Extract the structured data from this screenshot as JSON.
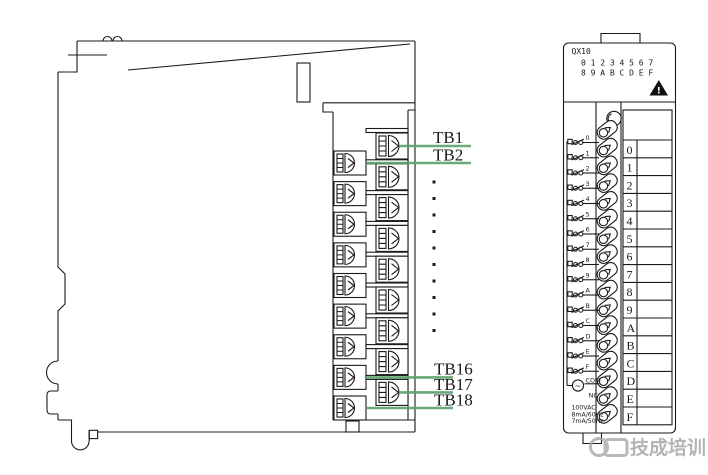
{
  "left_module": {
    "terminal_labels": [
      "TB1",
      "TB2",
      "TB16",
      "TB17",
      "TB18"
    ],
    "continuation_dots": 10,
    "inner_terminal_count": 9,
    "outer_terminal_count": 9
  },
  "right_module": {
    "model": "QX10",
    "indicator_row1": "0 1 2 3 4 5 6 7",
    "indicator_row2": "8 9 A B C D E F",
    "warning_icon": "warning-triangle",
    "switch_labels": [
      "0",
      "1",
      "2",
      "3",
      "4",
      "5",
      "6",
      "7",
      "8",
      "9",
      "A",
      "B",
      "C",
      "D",
      "E",
      "F"
    ],
    "com_label": "COM",
    "ac_symbol": "~",
    "nc_label": "NC",
    "ratings": [
      "100VAC",
      "8mA/60Hz",
      "7mA/50Hz"
    ],
    "table_labels": [
      "0",
      "1",
      "2",
      "3",
      "4",
      "5",
      "6",
      "7",
      "8",
      "9",
      "A",
      "B",
      "C",
      "D",
      "E",
      "F"
    ],
    "strip_terminal_count": 17
  },
  "watermark": {
    "text": "技成培训"
  },
  "colors": {
    "leader_green": "#5aa06b",
    "line": "#1a1a1a",
    "watermark_gray": "#a2a2a2"
  }
}
